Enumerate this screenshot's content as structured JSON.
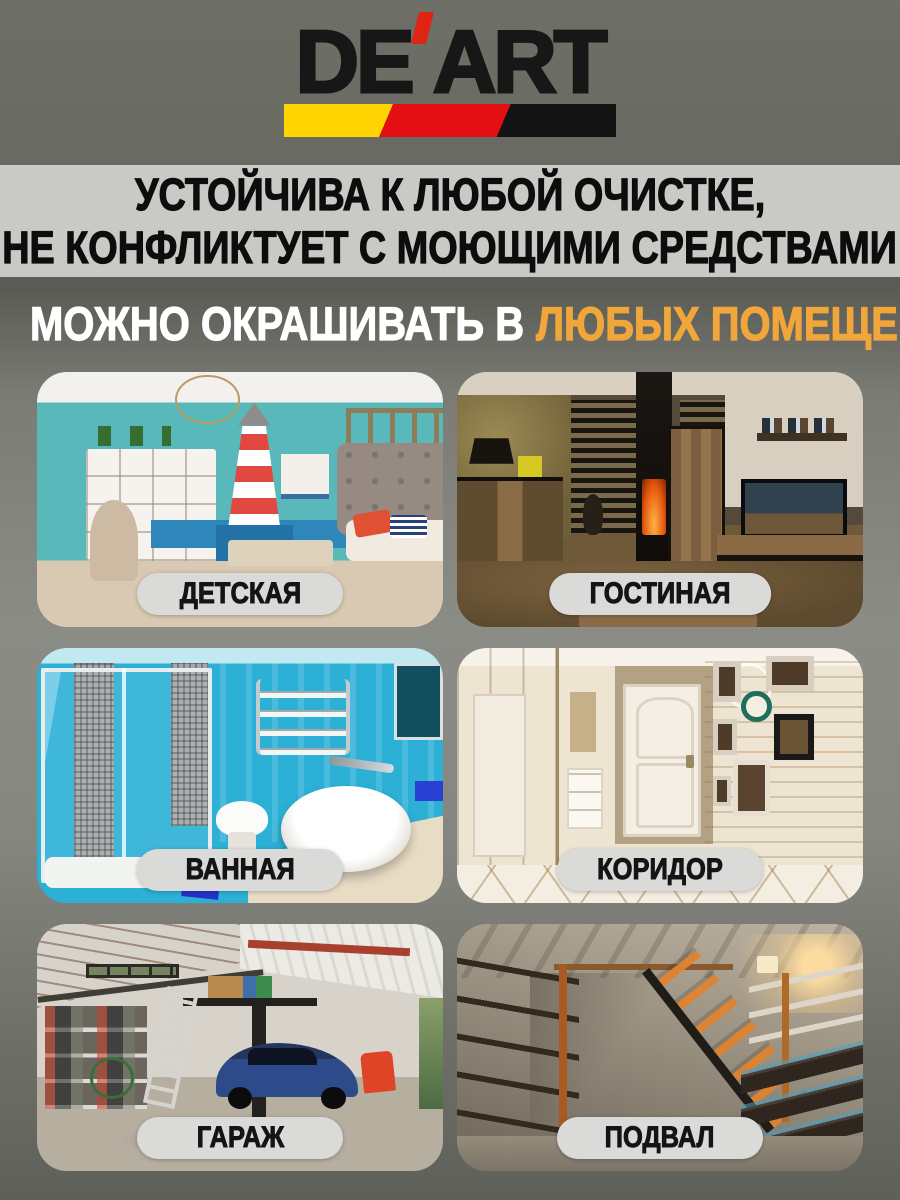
{
  "brand": {
    "name": "DE'ART",
    "name_prefix": "DE",
    "apostrophe": "'",
    "name_suffix": "ART",
    "stripe_colors": [
      "#ffd400",
      "#e30f13",
      "#141414"
    ]
  },
  "banner": {
    "line1": "УСТОЙЧИВА К ЛЮБОЙ ОЧИСТКЕ,",
    "line2": "НЕ КОНФЛИКТУЕТ С МОЮЩИМИ СРЕДСТВАМИ"
  },
  "heading": {
    "prefix": "МОЖНО ОКРАШИВАТЬ В",
    "highlight": "ЛЮБЫХ ПОМЕЩЕНИЯХ",
    "highlight_color": "#f0a63a"
  },
  "rooms": [
    {
      "label": "ДЕТСКАЯ"
    },
    {
      "label": "ГОСТИНАЯ"
    },
    {
      "label": "ВАННАЯ"
    },
    {
      "label": "КОРИДОР"
    },
    {
      "label": "ГАРАЖ"
    },
    {
      "label": "ПОДВАЛ"
    }
  ]
}
